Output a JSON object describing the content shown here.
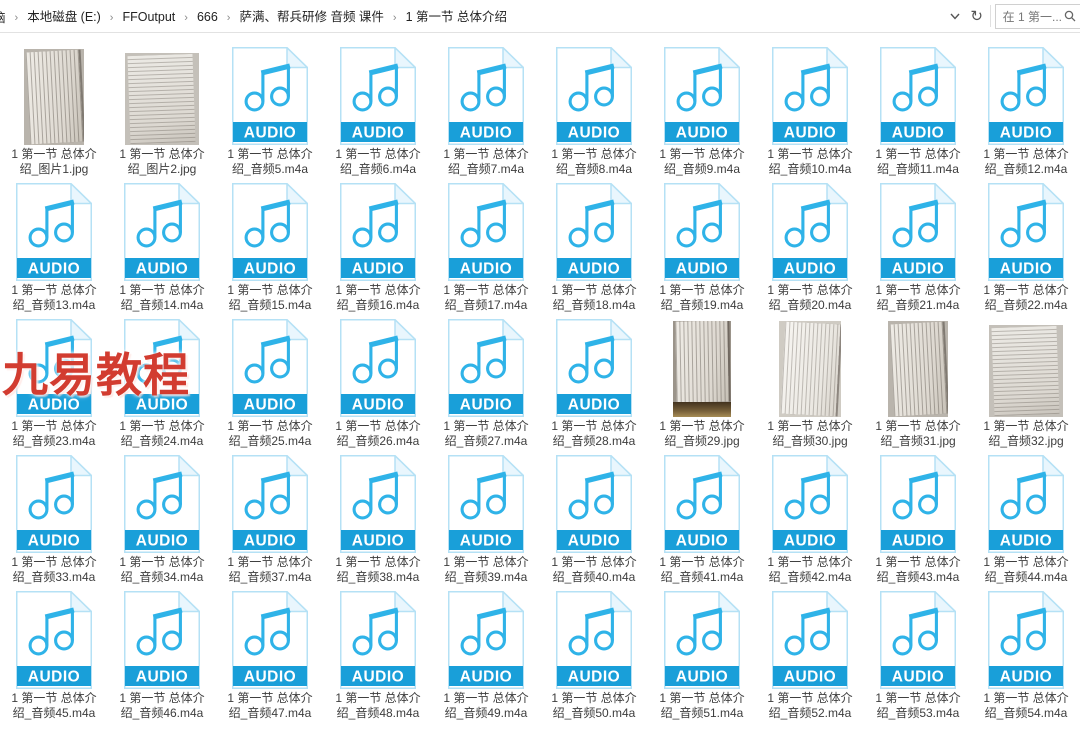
{
  "topbar": {
    "breadcrumb": {
      "overflow": "脑",
      "separator": "›",
      "items": [
        "本地磁盘 (E:)",
        "FFOutput",
        "666",
        "萨满、帮兵研修 音频 课件",
        "1 第一节 总体介绍"
      ]
    },
    "icons": {
      "dropdown": "chevron-down",
      "refresh_glyph": "↻",
      "search": "magnifier"
    },
    "search": {
      "value": "在 1 第一..."
    }
  },
  "audio_badge": "AUDIO",
  "watermark": "九易教程",
  "colors": {
    "audio_banner": "#199fd9",
    "note_cyan": "#2fb3e8",
    "page_border": "#b5e1f5",
    "watermark_red": "#d23c30"
  },
  "files": [
    {
      "kind": "image",
      "thumb": "book-page-portrait",
      "line1": "1 第一节 总体介",
      "line2": "绍_图片1.jpg"
    },
    {
      "kind": "image",
      "thumb": "book-page-landscape",
      "line1": "1 第一节 总体介",
      "line2": "绍_图片2.jpg"
    },
    {
      "kind": "audio",
      "line1": "1 第一节 总体介",
      "line2": "绍_音频5.m4a"
    },
    {
      "kind": "audio",
      "line1": "1 第一节 总体介",
      "line2": "绍_音频6.m4a"
    },
    {
      "kind": "audio",
      "line1": "1 第一节 总体介",
      "line2": "绍_音频7.m4a"
    },
    {
      "kind": "audio",
      "line1": "1 第一节 总体介",
      "line2": "绍_音频8.m4a"
    },
    {
      "kind": "audio",
      "line1": "1 第一节 总体介",
      "line2": "绍_音频9.m4a"
    },
    {
      "kind": "audio",
      "line1": "1 第一节 总体介",
      "line2": "绍_音频10.m4a"
    },
    {
      "kind": "audio",
      "line1": "1 第一节 总体介",
      "line2": "绍_音频11.m4a"
    },
    {
      "kind": "audio",
      "line1": "1 第一节 总体介",
      "line2": "绍_音频12.m4a"
    },
    {
      "kind": "audio",
      "line1": "1 第一节 总体介",
      "line2": "绍_音频13.m4a"
    },
    {
      "kind": "audio",
      "line1": "1 第一节 总体介",
      "line2": "绍_音频14.m4a"
    },
    {
      "kind": "audio",
      "line1": "1 第一节 总体介",
      "line2": "绍_音频15.m4a"
    },
    {
      "kind": "audio",
      "line1": "1 第一节 总体介",
      "line2": "绍_音频16.m4a"
    },
    {
      "kind": "audio",
      "line1": "1 第一节 总体介",
      "line2": "绍_音频17.m4a"
    },
    {
      "kind": "audio",
      "line1": "1 第一节 总体介",
      "line2": "绍_音频18.m4a"
    },
    {
      "kind": "audio",
      "line1": "1 第一节 总体介",
      "line2": "绍_音频19.m4a"
    },
    {
      "kind": "audio",
      "line1": "1 第一节 总体介",
      "line2": "绍_音频20.m4a"
    },
    {
      "kind": "audio",
      "line1": "1 第一节 总体介",
      "line2": "绍_音频21.m4a"
    },
    {
      "kind": "audio",
      "line1": "1 第一节 总体介",
      "line2": "绍_音频22.m4a"
    },
    {
      "kind": "audio",
      "line1": "1 第一节 总体介",
      "line2": "绍_音频23.m4a"
    },
    {
      "kind": "audio",
      "line1": "1 第一节 总体介",
      "line2": "绍_音频24.m4a"
    },
    {
      "kind": "audio",
      "line1": "1 第一节 总体介",
      "line2": "绍_音频25.m4a"
    },
    {
      "kind": "audio",
      "line1": "1 第一节 总体介",
      "line2": "绍_音频26.m4a"
    },
    {
      "kind": "audio",
      "line1": "1 第一节 总体介",
      "line2": "绍_音频27.m4a"
    },
    {
      "kind": "audio",
      "line1": "1 第一节 总体介",
      "line2": "绍_音频28.m4a"
    },
    {
      "kind": "image",
      "thumb": "book-page-dark-bottom",
      "line1": "1 第一节 总体介",
      "line2": "绍_音频29.jpg"
    },
    {
      "kind": "image",
      "thumb": "book-page-portrait-light",
      "line1": "1 第一节 总体介",
      "line2": "绍_音频30.jpg"
    },
    {
      "kind": "image",
      "thumb": "book-page-portrait",
      "line1": "1 第一节 总体介",
      "line2": "绍_音频31.jpg"
    },
    {
      "kind": "image",
      "thumb": "book-page-landscape",
      "line1": "1 第一节 总体介",
      "line2": "绍_音频32.jpg"
    },
    {
      "kind": "audio",
      "line1": "1 第一节 总体介",
      "line2": "绍_音频33.m4a"
    },
    {
      "kind": "audio",
      "line1": "1 第一节 总体介",
      "line2": "绍_音频34.m4a"
    },
    {
      "kind": "audio",
      "line1": "1 第一节 总体介",
      "line2": "绍_音频37.m4a"
    },
    {
      "kind": "audio",
      "line1": "1 第一节 总体介",
      "line2": "绍_音频38.m4a"
    },
    {
      "kind": "audio",
      "line1": "1 第一节 总体介",
      "line2": "绍_音频39.m4a"
    },
    {
      "kind": "audio",
      "line1": "1 第一节 总体介",
      "line2": "绍_音频40.m4a"
    },
    {
      "kind": "audio",
      "line1": "1 第一节 总体介",
      "line2": "绍_音频41.m4a"
    },
    {
      "kind": "audio",
      "line1": "1 第一节 总体介",
      "line2": "绍_音频42.m4a"
    },
    {
      "kind": "audio",
      "line1": "1 第一节 总体介",
      "line2": "绍_音频43.m4a"
    },
    {
      "kind": "audio",
      "line1": "1 第一节 总体介",
      "line2": "绍_音频44.m4a"
    },
    {
      "kind": "audio",
      "line1": "1 第一节 总体介",
      "line2": "绍_音频45.m4a"
    },
    {
      "kind": "audio",
      "line1": "1 第一节 总体介",
      "line2": "绍_音频46.m4a"
    },
    {
      "kind": "audio",
      "line1": "1 第一节 总体介",
      "line2": "绍_音频47.m4a"
    },
    {
      "kind": "audio",
      "line1": "1 第一节 总体介",
      "line2": "绍_音频48.m4a"
    },
    {
      "kind": "audio",
      "line1": "1 第一节 总体介",
      "line2": "绍_音频49.m4a"
    },
    {
      "kind": "audio",
      "line1": "1 第一节 总体介",
      "line2": "绍_音频50.m4a"
    },
    {
      "kind": "audio",
      "line1": "1 第一节 总体介",
      "line2": "绍_音频51.m4a"
    },
    {
      "kind": "audio",
      "line1": "1 第一节 总体介",
      "line2": "绍_音频52.m4a"
    },
    {
      "kind": "audio",
      "line1": "1 第一节 总体介",
      "line2": "绍_音频53.m4a"
    },
    {
      "kind": "audio",
      "line1": "1 第一节 总体介",
      "line2": "绍_音频54.m4a"
    }
  ]
}
